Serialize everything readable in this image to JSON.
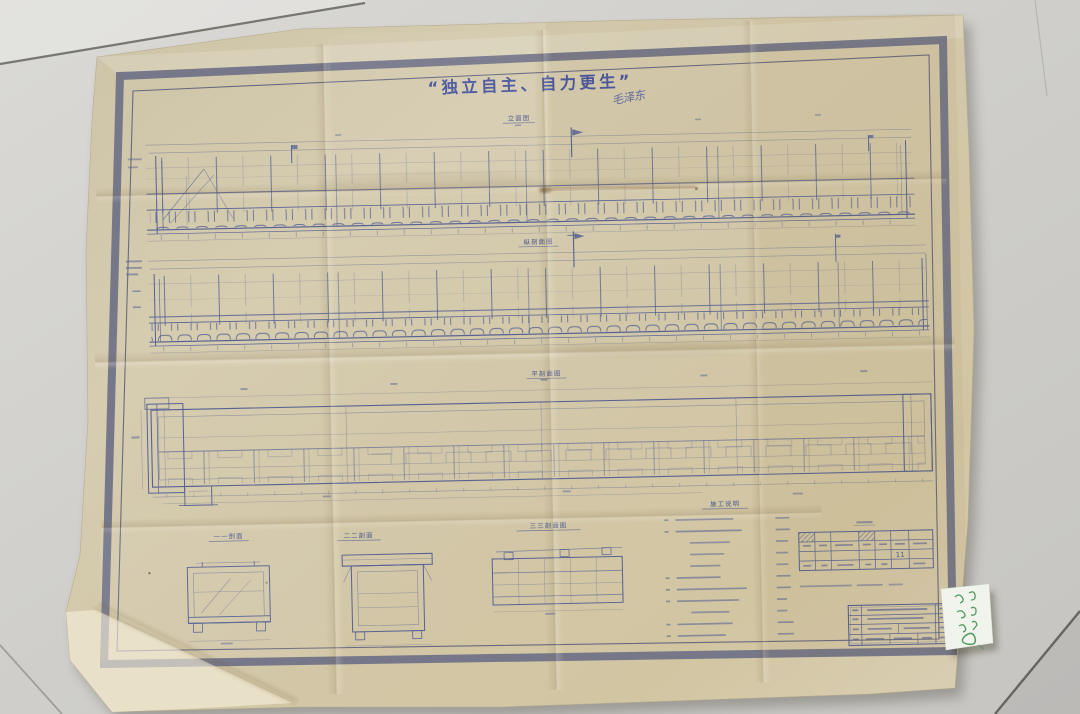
{
  "sheet": {
    "slogan": "“独立自主、自力更生”",
    "signature": "毛泽东",
    "labels": {
      "view1": "立面图",
      "view2": "纵剖面图",
      "view3": "平剖面图",
      "detail_a": "一一剖面",
      "detail_b": "二二剖面",
      "detail_c": "三三剖面图",
      "notes_heading": "施工说明"
    },
    "materials_table": {
      "cell_value": "11"
    },
    "colors": {
      "paper": "#d3c8ab",
      "border_band": "#6e7187",
      "ink": "#566293",
      "slogan_ink": "#3d4d9d",
      "note_green": "#3f9150",
      "floor": "#cfceca"
    }
  }
}
